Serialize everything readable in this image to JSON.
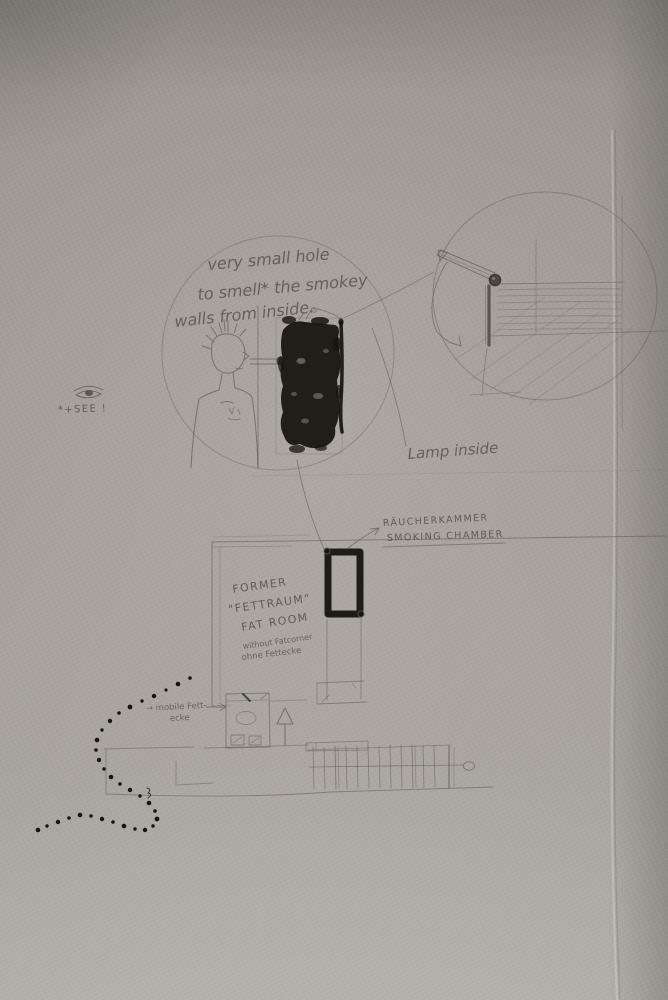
{
  "photo": {
    "wall_color": "#a6a099",
    "pencil_color": "#56504a",
    "ink_color": "#17130e"
  },
  "vignette_note": {
    "line1": "very small hole",
    "line2": "to smell* the smokey",
    "line3": "walls from inside."
  },
  "see_note": {
    "icon": "eye-icon",
    "label": "*+SEE !"
  },
  "lamp_note": {
    "label": "Lamp inside"
  },
  "chamber_label": {
    "de": "RÄUCHERKAMMER",
    "en": "SMOKING CHAMBER"
  },
  "fat_room_note": {
    "line1": "FORMER",
    "line2": "\"FETTRAUM\"",
    "line3": "FAT ROOM",
    "line4": "without Fatcorner",
    "line5": "ohne Fettecke"
  },
  "mobile_fettecke_note": {
    "line1": "→ mobile Fett-",
    "line2": "ecke"
  }
}
